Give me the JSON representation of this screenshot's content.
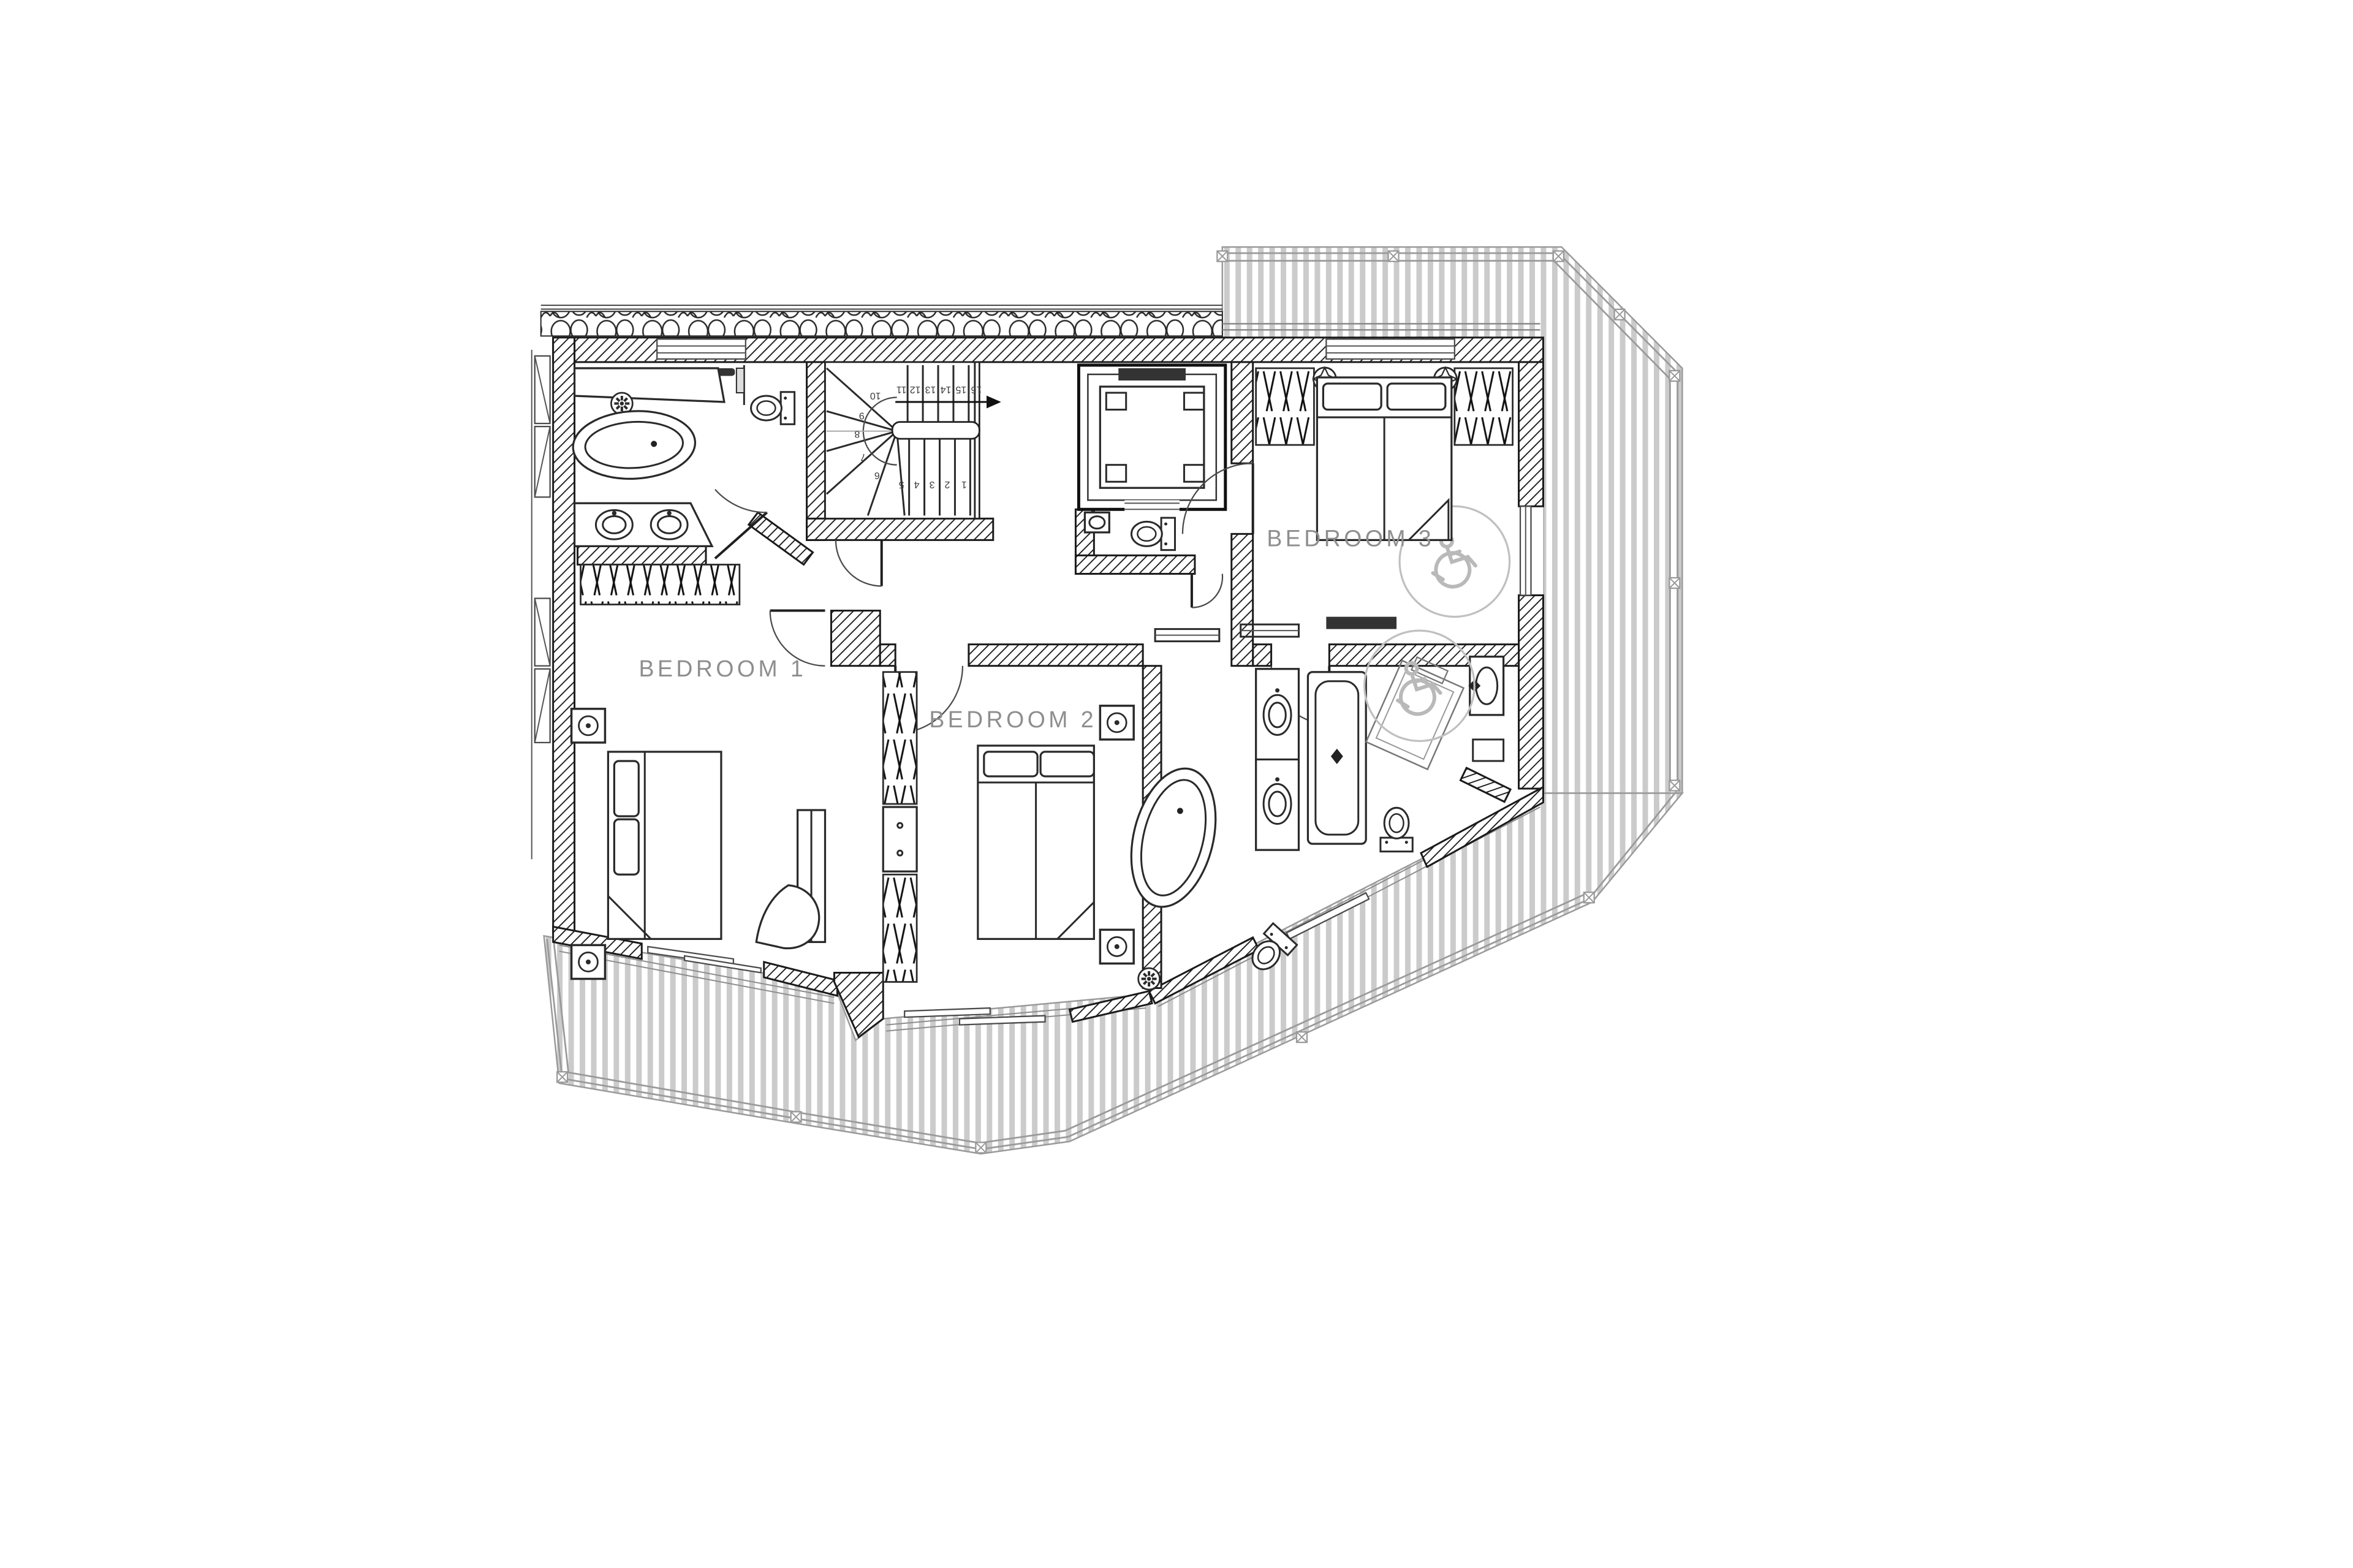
{
  "colors": {
    "wall": "#1b1b1b",
    "line": "#2a2a2a",
    "label": "#8e8e8e",
    "deck_stripe": "#cbcbcb",
    "accessory": "#c0c0c0",
    "background": "#ffffff"
  },
  "plan": {
    "rooms": [
      {
        "label": "BEDROOM 1"
      },
      {
        "label": "BEDROOM 2"
      },
      {
        "label": "BEDROOM 3"
      }
    ],
    "stairs": {
      "numbers": [
        "1",
        "2",
        "3",
        "4",
        "5",
        "6",
        "7",
        "8",
        "9",
        "10",
        "11",
        "12",
        "13",
        "14",
        "15",
        "16"
      ]
    }
  }
}
